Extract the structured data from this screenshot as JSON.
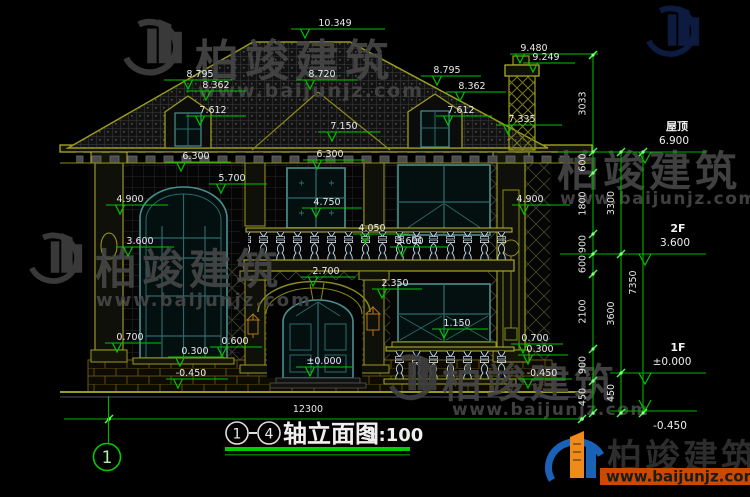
{
  "brand": {
    "name": "柏竣建筑",
    "site": "www.baijunjz.com"
  },
  "title": {
    "axis_start": "1",
    "axis_end": "4",
    "name": "轴立面图",
    "scale": "1:100"
  },
  "axis_bubble": "1",
  "overall_width": "12300",
  "floors": {
    "roof_label": "屋顶",
    "roof_value": "6.900",
    "f2_label": "2F",
    "f2_value": "3.600",
    "f1_label": "1F",
    "f1_value": "±0.000",
    "basement_value": "-0.450"
  },
  "levels": {
    "ridge": "10.349",
    "front_hip": "8.720",
    "chimney_top": "9.480",
    "chimney_cap": "9.249",
    "dormer_left_top": "8.795",
    "dormer_left_eave": "8.362",
    "dormer_left_sill": "7.612",
    "dormer_right_top": "8.795",
    "dormer_right_eave": "8.362",
    "dormer_right_sill": "7.612",
    "eave_right": "7.335",
    "eave_center": "7.150",
    "eave_left_bay": "6.300",
    "eave_center_bay": "6.300",
    "arch_top": "5.700",
    "left_capital": "4.900",
    "right_capital": "4.900",
    "window_head": "4.750",
    "balcony_rail": "4.050",
    "balcony_floor": "3.600",
    "left_transom": "3.600",
    "porch_head": "2.700",
    "porch_spring": "2.350",
    "sill_1f": "1.150",
    "rail_left": "0.700",
    "rail_right": "0.700",
    "base_left": "0.300",
    "base_right": "0.300",
    "base_mid": "0.600",
    "ground_left": "-0.450",
    "ground_right": "-0.450",
    "door_zero": "±0.000"
  },
  "chains": {
    "inner": [
      "3033",
      "600",
      "1800",
      "900",
      "600",
      "2100",
      "900",
      "450"
    ],
    "mid": [
      "3300",
      "3600",
      "450"
    ],
    "outer": [
      "7350"
    ]
  }
}
